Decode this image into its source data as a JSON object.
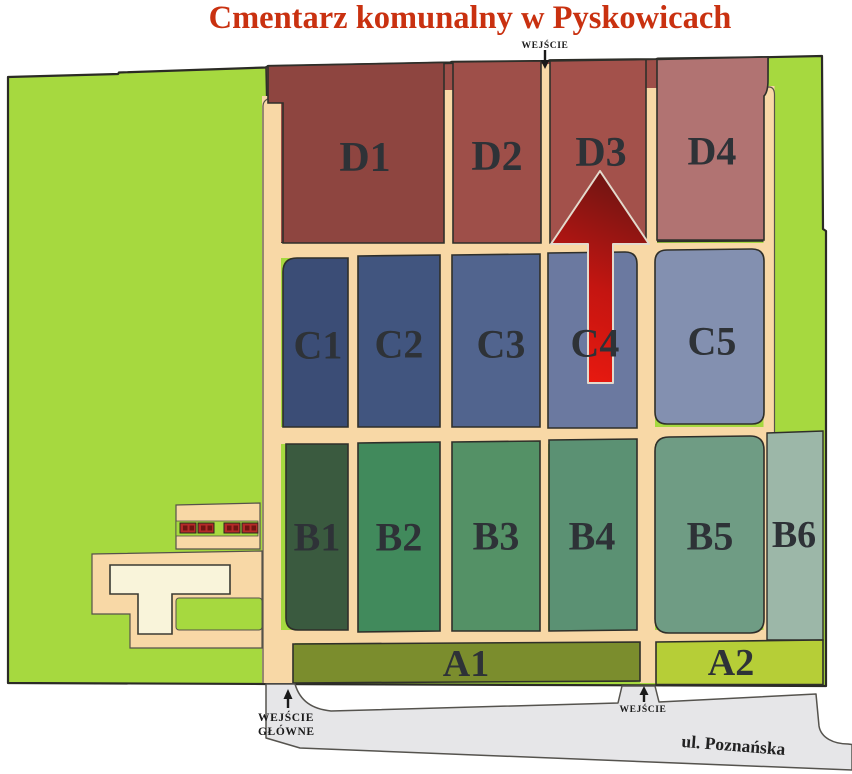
{
  "title": {
    "text": "Cmentarz komunalny w Pyskowicach",
    "color": "#c93110"
  },
  "map": {
    "background_color": "#a6d93f",
    "path_color": "#f8d8a6",
    "road_color": "#e6e6e8",
    "building_color": "#f9f4da",
    "block_color": "#b52a28",
    "sections": {
      "D": [
        {
          "label": "D1",
          "color": "#8e4540"
        },
        {
          "label": "D2",
          "color": "#9e4f49"
        },
        {
          "label": "D3",
          "color": "#a3514b"
        },
        {
          "label": "D4",
          "color": "#b17372"
        }
      ],
      "C": [
        {
          "label": "C1",
          "color": "#3b4d76"
        },
        {
          "label": "C2",
          "color": "#41557f"
        },
        {
          "label": "C3",
          "color": "#51648e"
        },
        {
          "label": "C4",
          "color": "#6b79a0"
        },
        {
          "label": "C5",
          "color": "#8390b0"
        }
      ],
      "B": [
        {
          "label": "B1",
          "color": "#3a5a3f"
        },
        {
          "label": "B2",
          "color": "#418a5c"
        },
        {
          "label": "B3",
          "color": "#549166"
        },
        {
          "label": "B4",
          "color": "#5b9173"
        },
        {
          "label": "B5",
          "color": "#6f9c84"
        },
        {
          "label": "B6",
          "color": "#9cb7a8"
        }
      ],
      "A": [
        {
          "label": "A1",
          "color": "#7b8d2d"
        },
        {
          "label": "A2",
          "color": "#b6ce37"
        }
      ]
    },
    "entrances": {
      "north": {
        "label": "WEJŚCIE"
      },
      "main": {
        "label_line1": "WEJŚCIE",
        "label_line2": "GŁÓWNE"
      },
      "south": {
        "label": "WEJŚCIE"
      }
    },
    "street": {
      "name": "ul. Poznańska"
    },
    "arrow": {
      "points_to": "D3",
      "color_start": "#ee1a0f",
      "color_end": "#5f1513"
    }
  }
}
